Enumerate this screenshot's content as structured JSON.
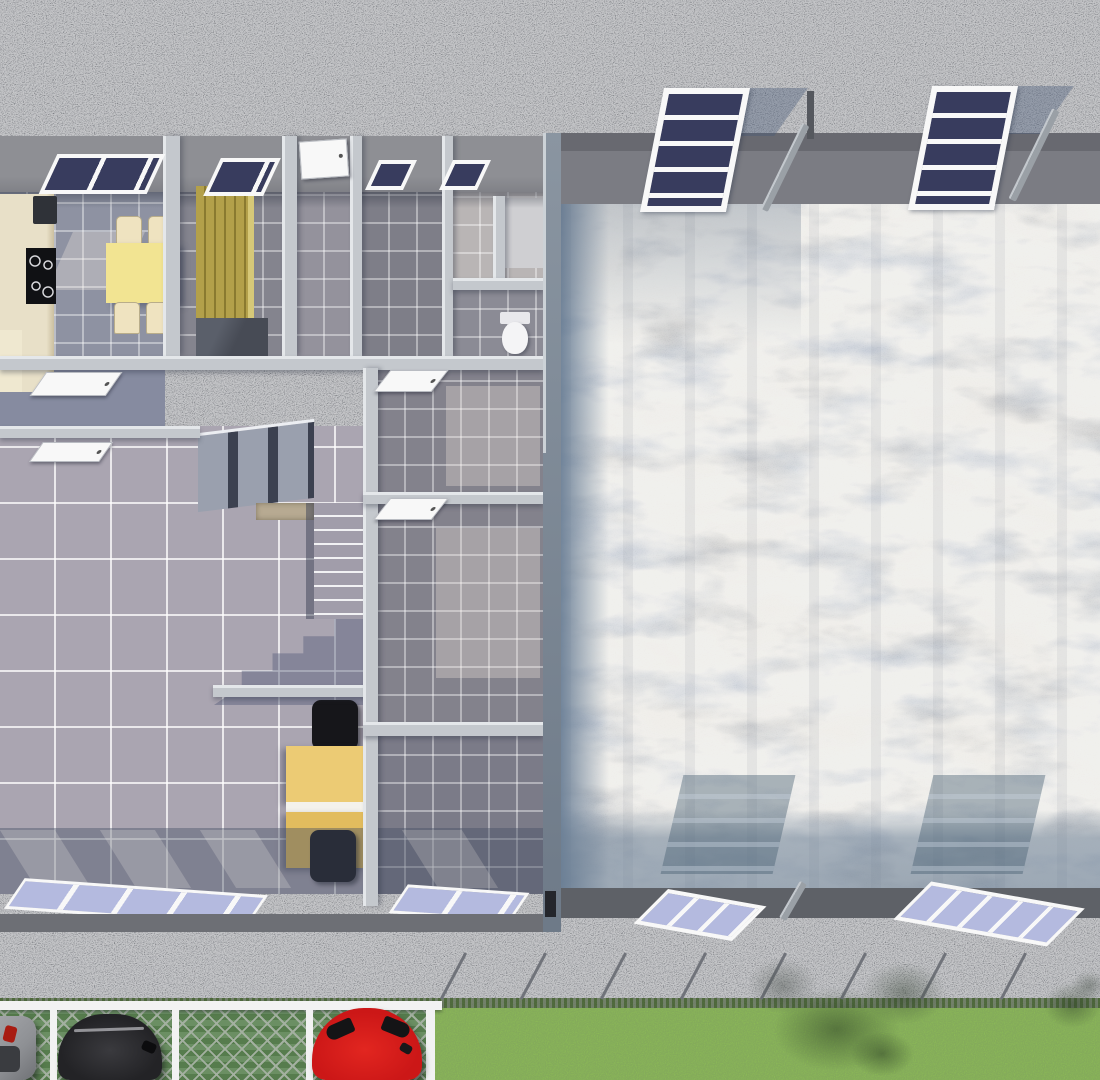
{
  "meta": {
    "type": "3d-architectural-render",
    "view": "top-down-dollhouse",
    "subject": "industrial hall with attached office and living wing, gravel yard, parking lot and lawn"
  },
  "colors": {
    "gravel": "#97979a",
    "wall_band_left": "#8e8f94",
    "wall_band_hall": "#7b7c83",
    "wall_band_hall_dark": "#686970",
    "wall_light": "#c4c8cd",
    "wall_hi": "#e4e7ea",
    "divider_top": "#8a95a1",
    "divider_bottom": "#6e7a88",
    "outer_wall": "#6d6f75",
    "walkway": "#5e6167",
    "tile_living": "#aaa5b1",
    "tile_dark": "#84848e",
    "tile_kitchen": "#8e92a2",
    "tile_corridor": "#7e7e88",
    "hall_floor": "#b3b1af",
    "window_navy": "#383c5e",
    "window_lavender": "#b4badf",
    "frame_white": "#f8f8f8",
    "counter_cream": "#e8e0c8",
    "counter_edge": "#cbbf9f",
    "table_yellow": "#f2e492",
    "chair_cream": "#efe3c0",
    "wardrobe_olive": "#b3a04a",
    "wardrobe_dark": "#8a7a30",
    "desk_wood_light": "#eccb74",
    "desk_wood": "#e2bc5e",
    "chair_black": "#16161a",
    "stone_landing": "#b7aa92",
    "riser_dark": "#3c4150",
    "tread_gray": "#9aa0ae",
    "dark_box": "#474b55",
    "strut_gray": "#9aa0a6",
    "car_red": "#cc1717",
    "car_black": "#232326",
    "car_silver": "#8e9094",
    "grass": "#8cbb56",
    "hedge_dark": "#44612f",
    "paver_green": "#6b8f63",
    "paver_line": "#a3b0a0",
    "rail_white": "#f2f2f2"
  },
  "building": {
    "left_wing": {
      "rooms": [
        {
          "name": "kitchen-dining",
          "furniture": [
            "counter",
            "sink",
            "cooktop",
            "dining-table",
            "four-chairs"
          ],
          "roof_window_panes": 2
        },
        {
          "name": "wardrobe-room",
          "furniture": [
            "slatted-wardrobe"
          ],
          "roof_window_panes": 1
        },
        {
          "name": "entry-hall",
          "features": [
            "white-entry-door"
          ]
        },
        {
          "name": "corridor",
          "roof_window_panes": 1,
          "features": [
            "open-door"
          ]
        },
        {
          "name": "bathroom-upper",
          "roof_window_panes": 1
        },
        {
          "name": "bathroom-lower",
          "furniture": [
            "toilet"
          ]
        },
        {
          "name": "living-room",
          "features": [
            "staircase-upper-flight",
            "stone-landing",
            "staircase-lower-flight",
            "stair-shadow"
          ]
        },
        {
          "name": "office-room-a",
          "features": [
            "open-door"
          ]
        },
        {
          "name": "office-room-b",
          "features": [
            "open-door"
          ]
        },
        {
          "name": "workstation-nook",
          "furniture": [
            "two-wooden-desks",
            "two-black-office-chairs"
          ]
        }
      ],
      "south_window_groups": 2
    },
    "hall": {
      "name": "industrial-hall",
      "floor": "concrete",
      "north_windows": 2,
      "south_windows": 2,
      "panes_per_window": 4,
      "features": [
        "window-shadows-on-floor",
        "diagonal-roof-struts",
        "perimeter-walkway"
      ]
    }
  },
  "exterior": {
    "ground": "gravel-yard",
    "parking": {
      "surface": "grass-paver-blocks",
      "spaces": 4,
      "cars": [
        {
          "position": "edge-left",
          "color_name": "silver",
          "hex": "#8e9094"
        },
        {
          "position": "space-2",
          "color_name": "black",
          "hex": "#232326"
        },
        {
          "position": "space-4",
          "color_name": "red",
          "hex": "#cc1717"
        }
      ],
      "features": [
        "white-rail-fence",
        "white-space-dividers"
      ]
    },
    "lawn": {
      "features": [
        "hedge-line",
        "diagonal-fence-posts",
        "tree-shadow-large",
        "tree-shadow-small"
      ]
    }
  }
}
